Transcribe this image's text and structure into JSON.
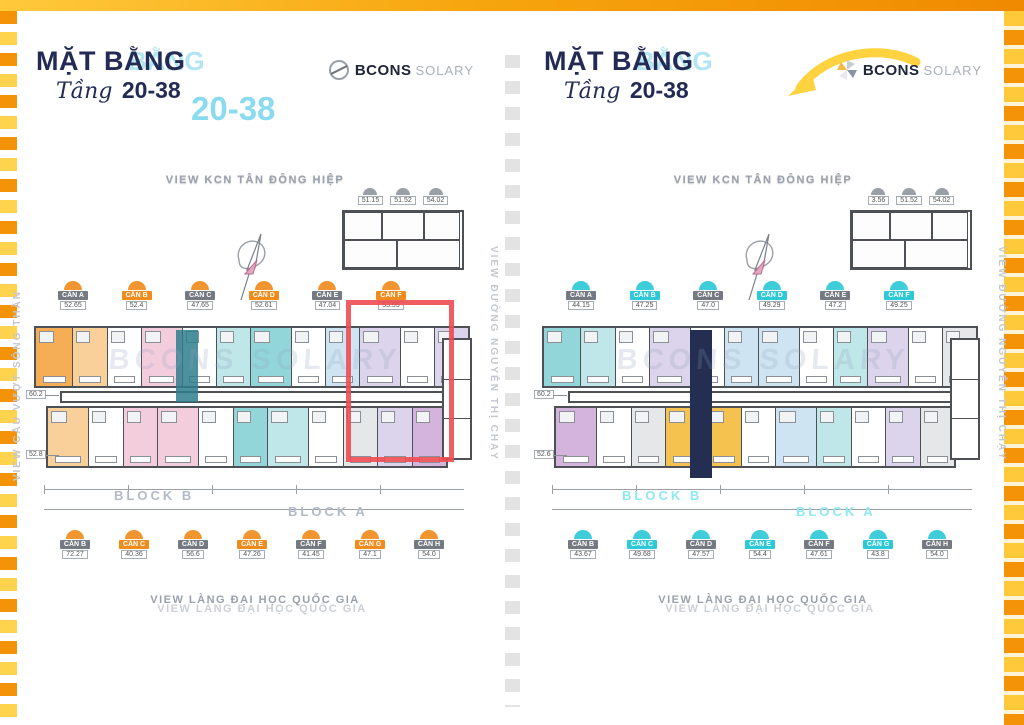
{
  "title": {
    "main": "MẶT BẰNG",
    "echo_word": "BẰNG",
    "script": "Tầng",
    "range": "20-38"
  },
  "logo": {
    "brand": "BCONS",
    "sub": "SOLARY"
  },
  "views": {
    "top": "VIEW KCN TÂN ĐÔNG HIỆP",
    "bottom": "VIEW LÀNG ĐẠI HỌC QUỐC GIA",
    "side_left": "VIEW CẦU VƯỢT SÓNG THẦN",
    "side_right": "VIEW ĐƯỜNG NGUYỄN THỊ CHẠY"
  },
  "blocks": {
    "b": "BLOCK B",
    "a": "BLOCK A"
  },
  "watermark": "BCONS SOLARY",
  "colors": {
    "navy": "#232b54",
    "cyan_accent": "#2ec9d6",
    "orange_accent": "#f08c1e",
    "red_highlight": "#ee4b52",
    "border_orange": "#f59308",
    "border_yellow": "#ffd34d"
  },
  "panels": {
    "left": {
      "top_units": [
        {
          "code": "CĂN A",
          "area": "52.65"
        },
        {
          "code": "CĂN B",
          "area": "52.4"
        },
        {
          "code": "CĂN C",
          "area": "47.65"
        },
        {
          "code": "CĂN D",
          "area": "52.61"
        },
        {
          "code": "CĂN E",
          "area": "47.04"
        },
        {
          "code": "CĂN F",
          "area": "53.55"
        }
      ],
      "bottom_units": [
        {
          "code": "CĂN B",
          "area": "72.27"
        },
        {
          "code": "CĂN C",
          "area": "40.36"
        },
        {
          "code": "CĂN D",
          "area": "56.6"
        },
        {
          "code": "CĂN E",
          "area": "47.26"
        },
        {
          "code": "CĂN F",
          "area": "41.45"
        },
        {
          "code": "CĂN G",
          "area": "47.1"
        },
        {
          "code": "CĂN H",
          "area": "54.0"
        }
      ],
      "mini_units": [
        "51.15",
        "51.52",
        "54.02"
      ],
      "callouts": [
        "60.2",
        "52.8"
      ]
    },
    "right": {
      "top_units": [
        {
          "code": "CĂN A",
          "area": "44.15"
        },
        {
          "code": "CĂN B",
          "area": "47.25"
        },
        {
          "code": "CĂN C",
          "area": "47.0"
        },
        {
          "code": "CĂN D",
          "area": "49.29"
        },
        {
          "code": "CĂN E",
          "area": "47.2"
        },
        {
          "code": "CĂN F",
          "area": "49.25"
        }
      ],
      "bottom_units": [
        {
          "code": "CĂN B",
          "area": "43.67"
        },
        {
          "code": "CĂN C",
          "area": "49.68"
        },
        {
          "code": "CĂN D",
          "area": "47.57"
        },
        {
          "code": "CĂN E",
          "area": "54.4"
        },
        {
          "code": "CĂN F",
          "area": "47.61"
        },
        {
          "code": "CĂN G",
          "area": "43.8"
        },
        {
          "code": "CĂN H",
          "area": "54.0"
        }
      ],
      "mini_units": [
        "3.56",
        "51.52",
        "54.02"
      ],
      "callouts": [
        "60.2",
        "52.6"
      ]
    }
  }
}
